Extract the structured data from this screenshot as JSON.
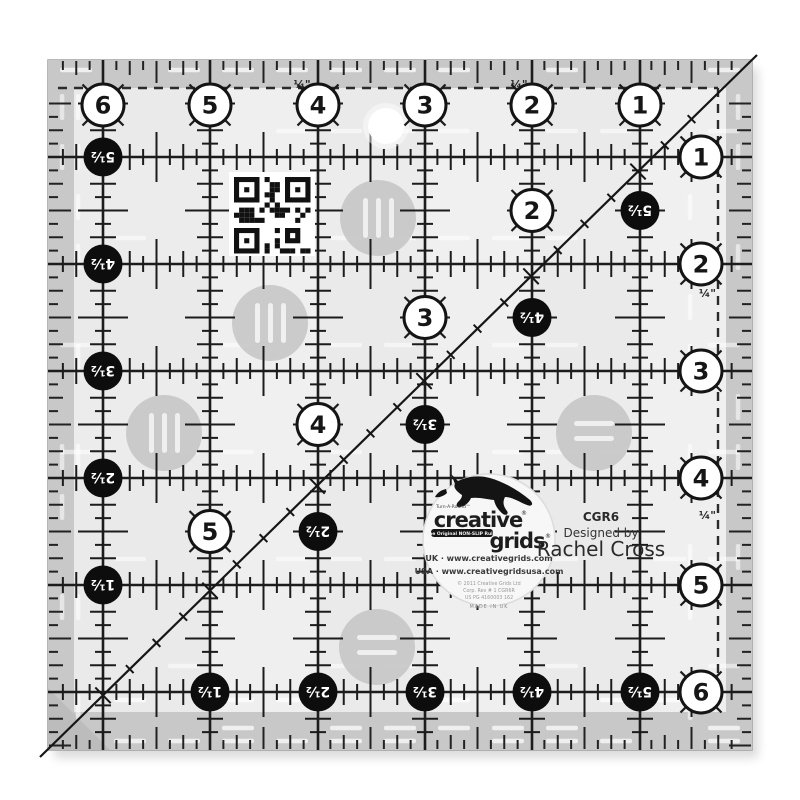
{
  "ruler": {
    "top_numbers": [
      "6",
      "5",
      "4",
      "3",
      "2",
      "1"
    ],
    "right_numbers": [
      "1",
      "2",
      "3",
      "4",
      "5",
      "6"
    ],
    "left_numbers": [
      "5½",
      "4½",
      "3½",
      "2½",
      "1½"
    ],
    "bottom_numbers": [
      "1½",
      "2½",
      "3½",
      "4½",
      "5½"
    ],
    "diagonal_black_numbers": [
      "5½",
      "4½",
      "3½",
      "2½"
    ],
    "inner_white_numbers": [
      "2",
      "3",
      "4",
      "5"
    ],
    "quarter_inch_label": "¼\""
  },
  "label": {
    "turn_a_round": "Turn-A-Round™",
    "brand_line1": "creative",
    "brand_line2": "grids",
    "registered": "®",
    "tagline": "The Original NON-SLIP Ruler",
    "uk_line": "UK · www.creativegrids.com",
    "usa_line": "USA · www.creativegridsusa.com",
    "copyright_line1": "© 2011 Creative Grids Ltd",
    "copyright_line2": "Corp. Rev # 1 CGR6R",
    "copyright_line3": "US PG 4160003 162",
    "made_in": "MADE IN UK",
    "model": "CGR6",
    "designed_by": "Designed by",
    "designer": "Rachel Cross"
  },
  "colors": {
    "field": "#eaeaea",
    "band": "#c8c8c8",
    "corner_triangle": "#bcbcbc",
    "grid_line": "#1c1c1c",
    "grip_dot": "#c6c6c6",
    "circle_black": "#0d0d0d",
    "circle_white": "#ffffff"
  }
}
